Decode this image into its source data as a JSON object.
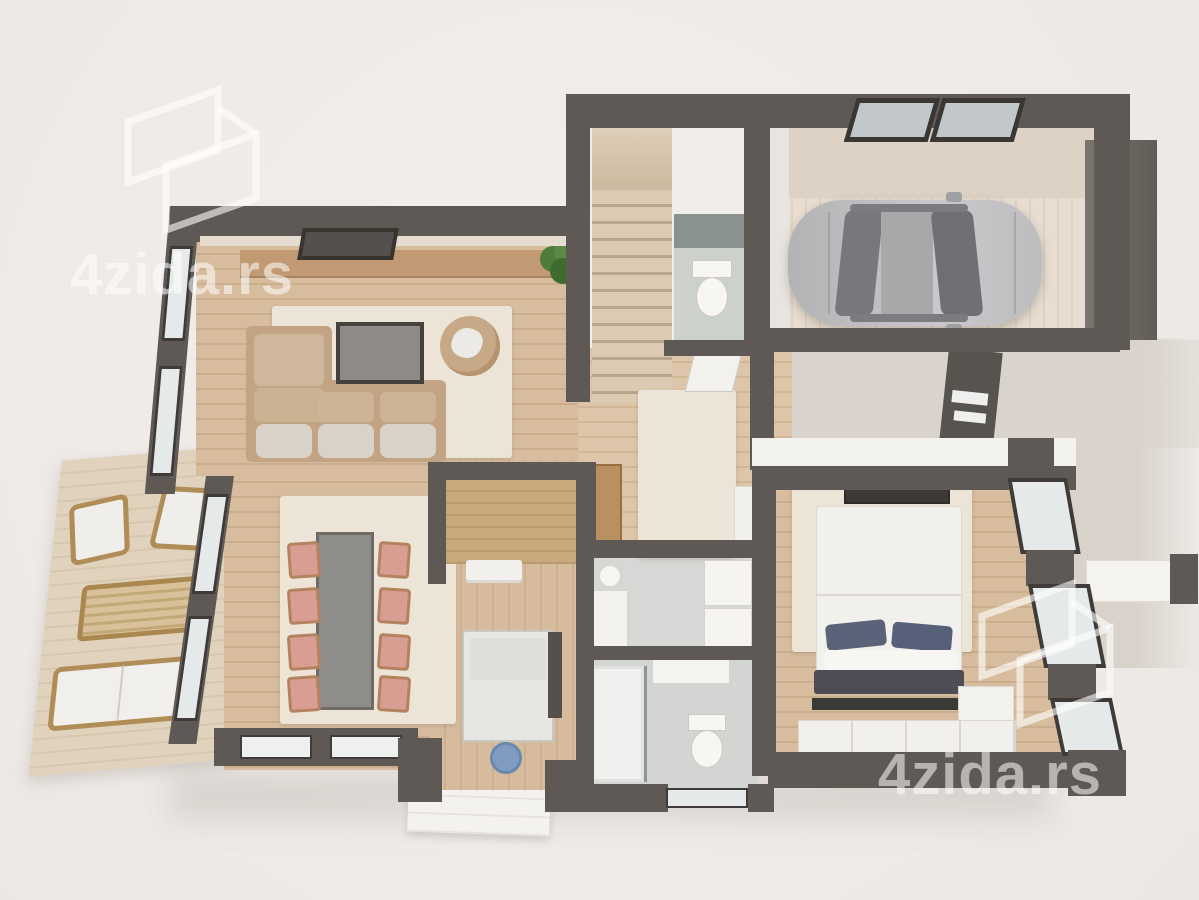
{
  "title": "3D floor plan render",
  "watermark": {
    "text": "4zida.rs",
    "top_left": {
      "text": "4zida.rs"
    },
    "bottom_right": {
      "text": "4zida.rs"
    },
    "color": "#ffffff",
    "opacity": 0.55
  },
  "palette": {
    "background": "#f0ece9",
    "wall": "#5e5954",
    "wood_floor": "#d7bd9e",
    "pale_wood": "#e8ddd0",
    "rug_cream": "#ece4d6",
    "concrete": "#d9d3cb",
    "tile_gray": "#d4d6d3",
    "sofa_tan": "#c2a383",
    "chair_salmon": "#d79e91",
    "pillow_blue": "#5b6379",
    "car_silver": "#b9b9bb",
    "plant_green": "#4e7d3a",
    "bowl_blue": "#7e9cc2",
    "window_glass": "#e6e9e9",
    "window_frame": "#3f3b38"
  },
  "inventory": [
    "sectional-sofa",
    "coffee-table",
    "round-armchair",
    "potted-plant",
    "tv-panel",
    "dining-table",
    "dining-chairs-x8",
    "staircase",
    "wc-toilet",
    "garage-car",
    "roof-skylights-x2",
    "double-bed",
    "blue-pillows-x2",
    "bed-foot-bench",
    "wardrobe",
    "dresser",
    "washer",
    "dryer",
    "laundry-basin",
    "walk-in-shower",
    "bathroom-sink",
    "bathroom-toilet",
    "terrace-armchairs-x2",
    "terrace-table",
    "terrace-bench",
    "entry-bench",
    "hall-sideboard",
    "kitchen-counter",
    "blue-bowl",
    "back-door-panel",
    "porch-steps",
    "garage-door",
    "patio-planter"
  ]
}
